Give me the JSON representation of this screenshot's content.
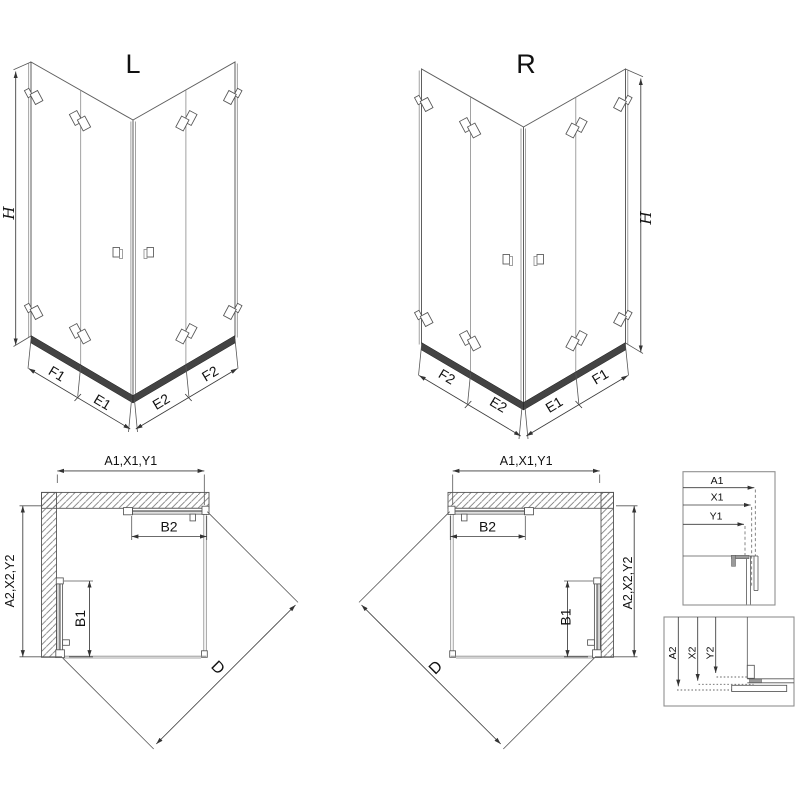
{
  "view_l": {
    "title": "L",
    "height": "H",
    "seg_f1": "F1",
    "seg_e1": "E1",
    "seg_e2": "E2",
    "seg_f2": "F2"
  },
  "view_r": {
    "title": "R",
    "height": "H",
    "seg_f2": "F2",
    "seg_e2": "E2",
    "seg_e1": "E1",
    "seg_f1": "F1"
  },
  "plan_l": {
    "width": "A1,X1,Y1",
    "depth": "A2,X2,Y2",
    "door_top": "B2",
    "door_side": "B1",
    "diagonal": "D"
  },
  "plan_r": {
    "width": "A1,X1,Y1",
    "depth": "A2,X2,Y2",
    "door_top": "B2",
    "door_side": "B1",
    "diagonal": "D"
  },
  "detail_widths": {
    "a1": "A1",
    "x1": "X1",
    "y1": "Y1"
  },
  "detail_depths": {
    "a2": "A2",
    "x2": "X2",
    "y2": "Y2"
  },
  "colors": {
    "line": "#5e5e5e",
    "glass_line": "#8a8a8a",
    "rail": "#434343",
    "hatch": "#777777",
    "dim": "#3a3a3a",
    "text": "#111111",
    "box_border": "#909090",
    "metal": "#9a9a9a",
    "background": "#ffffff"
  }
}
